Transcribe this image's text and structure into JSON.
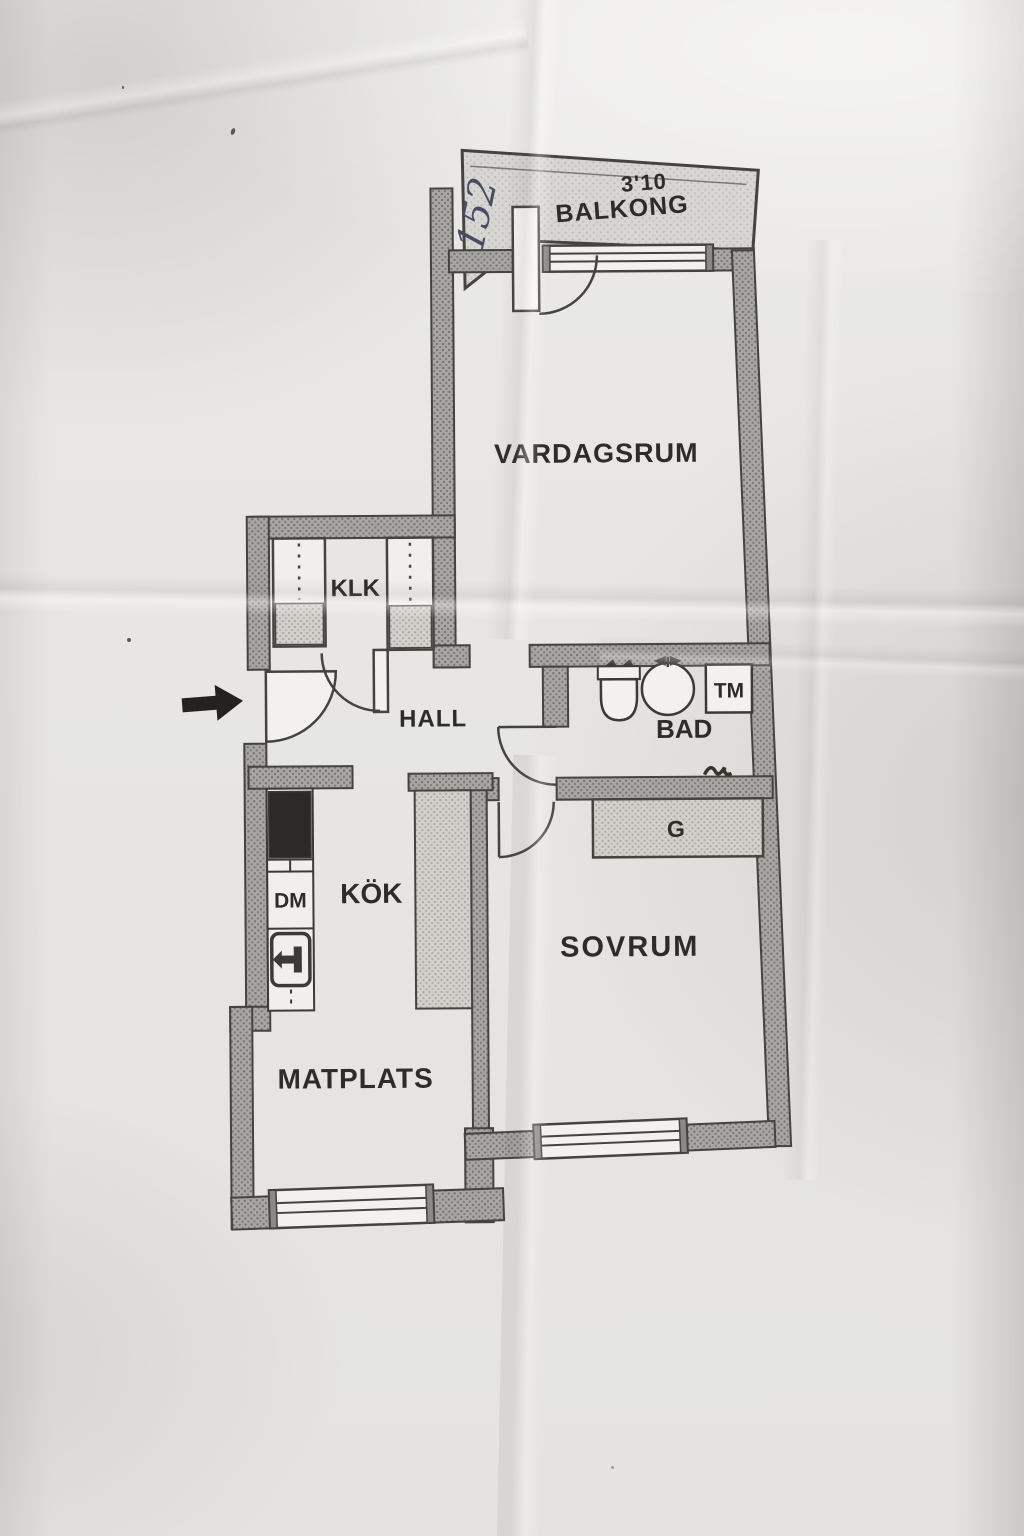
{
  "annotation": {
    "handwritten_number": "152"
  },
  "balcony": {
    "dimension": "3'10",
    "label": "BALKONG"
  },
  "rooms": {
    "livingroom": "VARDAGSRUM",
    "closet": "KLK",
    "hall": "HALL",
    "bathroom": "BAD",
    "bedroom": "SOVRUM",
    "kitchen": "KÖK",
    "dining": "MATPLATS"
  },
  "fixtures": {
    "washing_machine": "TM",
    "wardrobe": "G",
    "dishwasher": "DM"
  },
  "colors": {
    "paper": "#e8e7e4",
    "wall_fill": "#a7a5a1",
    "wall_line": "#45433f",
    "label_text": "#2e2c29",
    "pen_ink": "#474c60",
    "stove_black": "#2b2a27"
  }
}
